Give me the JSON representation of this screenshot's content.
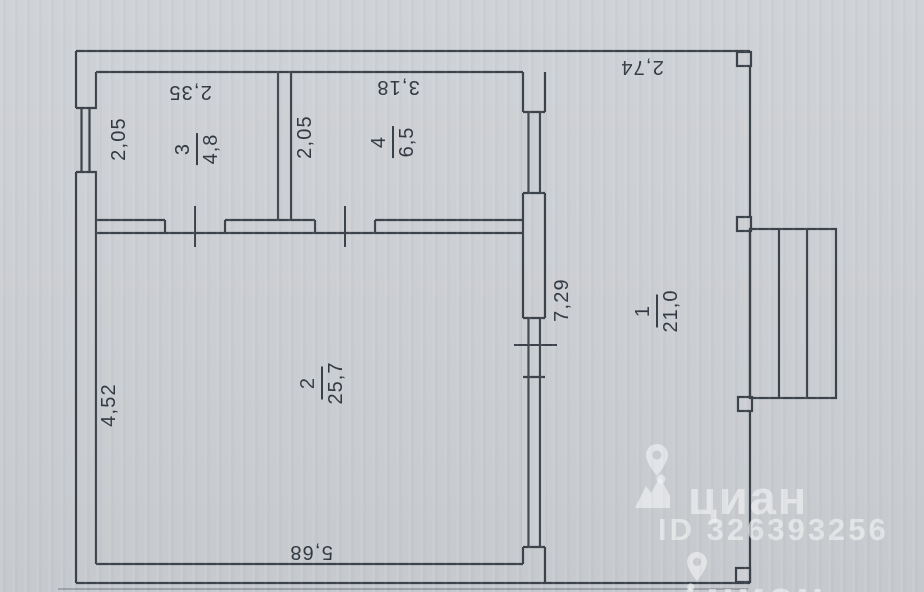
{
  "rooms": {
    "room3": {
      "number": "3",
      "area": "4,8",
      "width": "2,35",
      "height": "2,05"
    },
    "room4": {
      "number": "4",
      "area": "6,5",
      "width": "3,18",
      "height": "2,05"
    },
    "room2": {
      "number": "2",
      "area": "25,7",
      "width": "5,68",
      "height": "4,52"
    },
    "room1": {
      "number": "1",
      "area": "21,0",
      "width": "2,74",
      "height": "7,29"
    }
  },
  "watermark": {
    "brand": "циан",
    "listing_id": "ID 326393256",
    "brand_bottom": "циан"
  },
  "colors": {
    "line": "#3d434b",
    "paper": "#cccfd3",
    "watermark": "#f0f2f4"
  }
}
